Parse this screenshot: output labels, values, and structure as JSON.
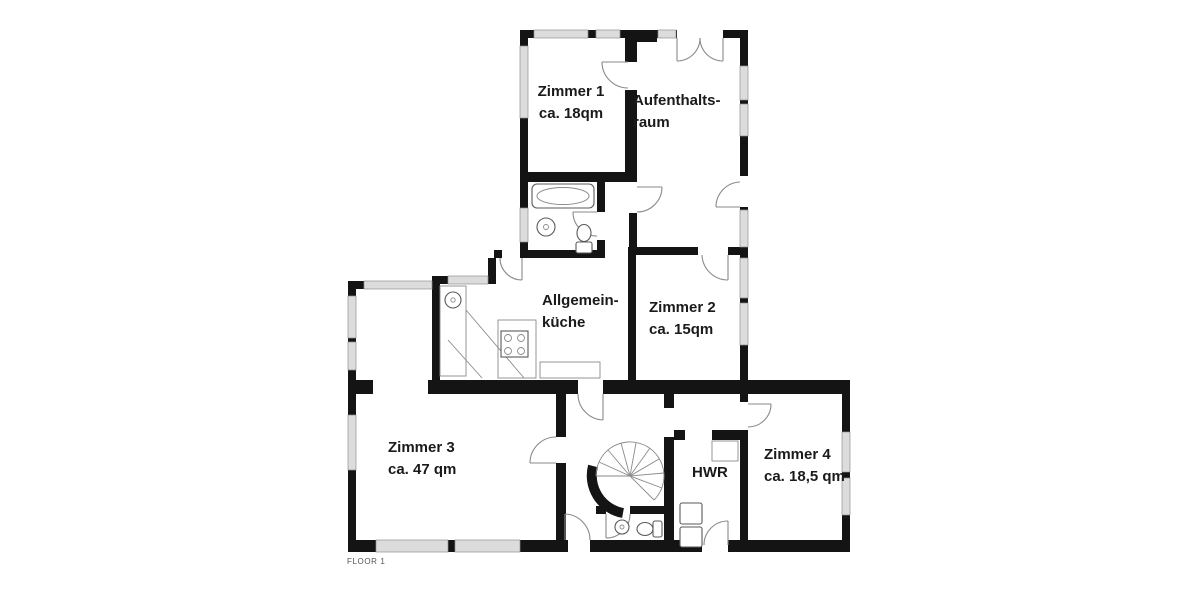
{
  "floor_plan": {
    "floor_label": "FLOOR 1",
    "rooms": {
      "zimmer1": {
        "lines": [
          "Zimmer 1",
          "ca. 18qm"
        ]
      },
      "aufenthaltsraum": {
        "lines": [
          "Aufenthalts-",
          "raum"
        ]
      },
      "zimmer2": {
        "lines": [
          "Zimmer 2",
          "ca. 15qm"
        ]
      },
      "kueche": {
        "lines": [
          "Allgemein-",
          "küche"
        ]
      },
      "zimmer3": {
        "lines": [
          "Zimmer 3",
          "ca. 47 qm"
        ]
      },
      "hwr": {
        "lines": [
          "HWR"
        ]
      },
      "zimmer4": {
        "lines": [
          "Zimmer 4",
          "ca. 18,5 qm"
        ]
      }
    },
    "fixtures": [
      "bathtub",
      "bath-sink",
      "toilet",
      "kitchen-counter",
      "kitchen-sink",
      "stove",
      "spiral-staircase",
      "washing-machines",
      "closet",
      "wc-sink",
      "wc-toilet"
    ],
    "colors": {
      "wall": "#141414",
      "window": "#dcdcdc",
      "door_arc": "#8a8a8a",
      "background": "#ffffff",
      "label_text": "#1a1a1a",
      "floor_label_text": "#555555"
    }
  }
}
